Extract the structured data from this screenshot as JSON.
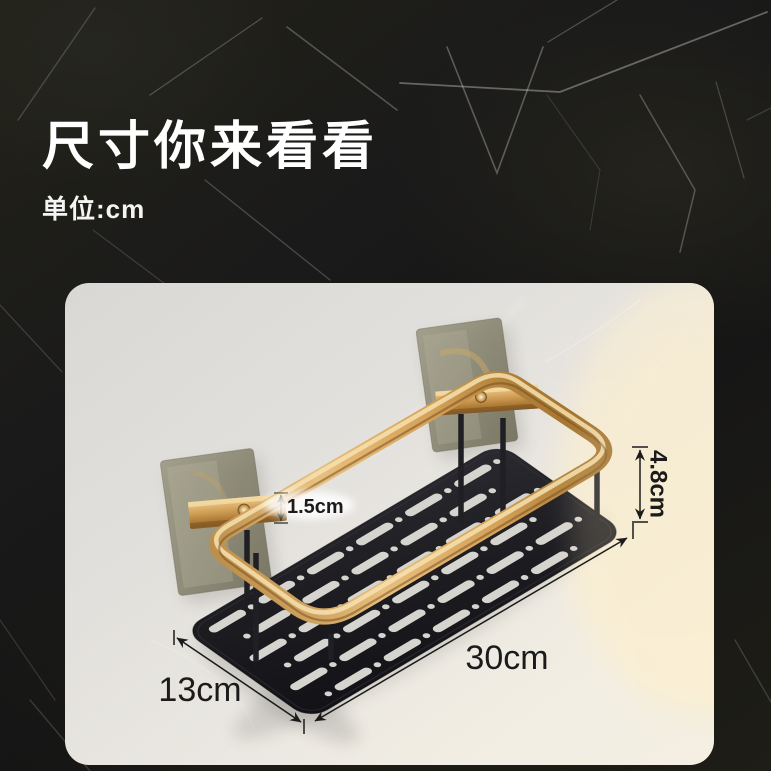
{
  "header": {
    "title": "尺寸你来看看",
    "subtitle": "单位:cm"
  },
  "dimensions": {
    "arm_thickness": "1.5cm",
    "rail_height": "4.8cm",
    "length": "30cm",
    "depth": "13cm"
  },
  "colors": {
    "marble_background": "#1a1915",
    "heading_text": "#ffffff",
    "wall_card": "#e6e3dd",
    "gold_frame": "#d0a055",
    "tray_black": "#1a1a1e",
    "adhesive_pad": "#8b8872",
    "dimension_text": "#1b1b1b"
  }
}
